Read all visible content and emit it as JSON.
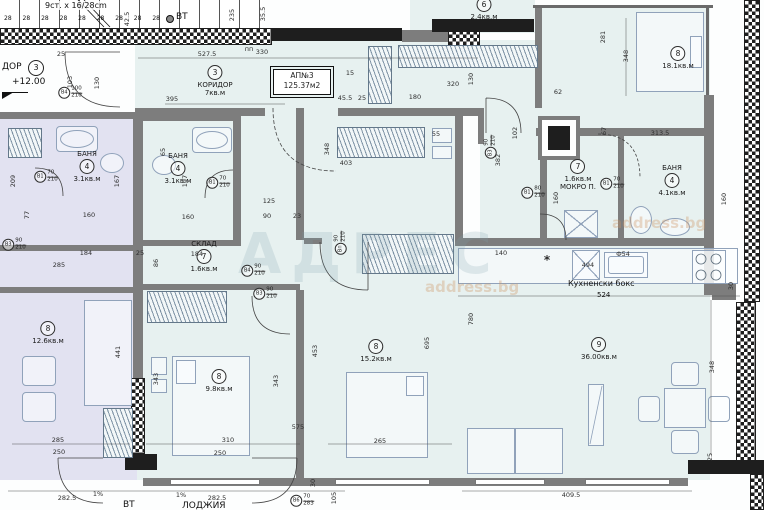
{
  "plan": {
    "apartment_box": {
      "line1": "АП№3",
      "line2": "125.37м2"
    },
    "stairs": {
      "note": "9ст. x 16/28cm",
      "treads": "28 28 28 28 28 28 28 28 28"
    },
    "landing": {
      "label": "ДОР",
      "num": "3",
      "level": "+12.00"
    },
    "vt_top": "ВТ",
    "vt_bottom": "ВТ",
    "kitchen": {
      "label": "Кухненски бокс",
      "dim": "524"
    },
    "loggia_label": "ЛОДЖИЯ",
    "watermark": {
      "main": "АДРЕС",
      "sub1": "address.bg",
      "sub2": "address.bg"
    },
    "rooms": [
      {
        "num": "3",
        "name": "КОРИДОР",
        "area": "7кв.м",
        "x": 215,
        "y": 64,
        "mode": "mid"
      },
      {
        "num": "6",
        "area": "2.4кв.м",
        "x": 484,
        "y": -4,
        "mode": "plain"
      },
      {
        "num": "8",
        "area": "18.1кв.м",
        "x": 678,
        "y": 45,
        "mode": "plain"
      },
      {
        "num": "4",
        "name": "БАНЯ",
        "area": "3.1кв.м",
        "x": 87,
        "y": 150,
        "mode": "above"
      },
      {
        "num": "4",
        "name": "БАНЯ",
        "area": "3.1кв.м",
        "x": 178,
        "y": 152,
        "mode": "above"
      },
      {
        "num": "7",
        "name": "СКЛАД",
        "area": "1.6кв.м",
        "x": 204,
        "y": 240,
        "mode": "above"
      },
      {
        "num": "7",
        "name": "МОКРО П.",
        "area": "1.6кв.м",
        "x": 578,
        "y": 158,
        "mode": "below"
      },
      {
        "num": "4",
        "name": "БАНЯ",
        "area": "4.1кв.м",
        "x": 672,
        "y": 164,
        "mode": "above"
      },
      {
        "num": "8",
        "area": "12.6кв.м",
        "x": 48,
        "y": 320,
        "mode": "plain"
      },
      {
        "num": "8",
        "area": "9.8кв.м",
        "x": 219,
        "y": 368,
        "mode": "plain"
      },
      {
        "num": "8",
        "area": "15.2кв.м",
        "x": 376,
        "y": 338,
        "mode": "plain"
      },
      {
        "num": "9",
        "area": "36.00кв.м",
        "x": 599,
        "y": 336,
        "mode": "plain"
      }
    ],
    "dims": [
      {
        "t": "527.5",
        "x": 207,
        "y": 54
      },
      {
        "t": "330",
        "x": 262,
        "y": 52
      },
      {
        "t": "25",
        "x": 61,
        "y": 54
      },
      {
        "t": "42.5",
        "x": 127,
        "y": 19,
        "r": 90
      },
      {
        "t": "235",
        "x": 232,
        "y": 15,
        "r": 90
      },
      {
        "t": "35.5",
        "x": 263,
        "y": 14,
        "r": 90
      },
      {
        "t": "пп",
        "x": 249,
        "y": 49
      },
      {
        "t": "395",
        "x": 172,
        "y": 99
      },
      {
        "t": "103",
        "x": 70,
        "y": 82,
        "r": 90
      },
      {
        "t": "130",
        "x": 97,
        "y": 83,
        "r": 90
      },
      {
        "t": "15",
        "x": 350,
        "y": 73
      },
      {
        "t": "45.5",
        "x": 345,
        "y": 98
      },
      {
        "t": "25",
        "x": 362,
        "y": 98
      },
      {
        "t": "320",
        "x": 453,
        "y": 84
      },
      {
        "t": "130",
        "x": 471,
        "y": 79,
        "r": 90
      },
      {
        "t": "180",
        "x": 415,
        "y": 97
      },
      {
        "t": "62",
        "x": 558,
        "y": 92
      },
      {
        "t": "281",
        "x": 603,
        "y": 37,
        "r": 90
      },
      {
        "t": "348",
        "x": 626,
        "y": 56,
        "r": 90
      },
      {
        "t": "313.5",
        "x": 660,
        "y": 133
      },
      {
        "t": "67",
        "x": 604,
        "y": 131,
        "r": 90
      },
      {
        "t": "102",
        "x": 515,
        "y": 133,
        "r": 90
      },
      {
        "t": "348",
        "x": 327,
        "y": 149,
        "r": 90
      },
      {
        "t": "403",
        "x": 346,
        "y": 163
      },
      {
        "t": "55",
        "x": 436,
        "y": 134
      },
      {
        "t": "125",
        "x": 269,
        "y": 201
      },
      {
        "t": "90",
        "x": 267,
        "y": 216
      },
      {
        "t": "23",
        "x": 297,
        "y": 216
      },
      {
        "t": "160",
        "x": 89,
        "y": 215
      },
      {
        "t": "160",
        "x": 188,
        "y": 217
      },
      {
        "t": "209",
        "x": 13,
        "y": 181,
        "r": 90
      },
      {
        "t": "197",
        "x": 185,
        "y": 181,
        "r": 90
      },
      {
        "t": "167",
        "x": 117,
        "y": 181,
        "r": 90
      },
      {
        "t": "77",
        "x": 27,
        "y": 215,
        "r": 90
      },
      {
        "t": "65",
        "x": 163,
        "y": 152,
        "r": 90
      },
      {
        "t": "184",
        "x": 86,
        "y": 253
      },
      {
        "t": "285",
        "x": 59,
        "y": 265
      },
      {
        "t": "86",
        "x": 156,
        "y": 263,
        "r": 90
      },
      {
        "t": "184",
        "x": 197,
        "y": 254
      },
      {
        "t": "25",
        "x": 140,
        "y": 253
      },
      {
        "t": "140",
        "x": 501,
        "y": 253
      },
      {
        "t": "382",
        "x": 498,
        "y": 160,
        "r": 90
      },
      {
        "t": "Ф54",
        "x": 623,
        "y": 254
      },
      {
        "t": "*",
        "x": 547,
        "y": 260,
        "big": 1
      },
      {
        "t": "494",
        "x": 588,
        "y": 265
      },
      {
        "t": "30",
        "x": 731,
        "y": 286,
        "r": 90
      },
      {
        "t": "160",
        "x": 556,
        "y": 198,
        "r": 90
      },
      {
        "t": "160",
        "x": 724,
        "y": 199,
        "r": 90
      },
      {
        "t": "780",
        "x": 471,
        "y": 319,
        "r": 90
      },
      {
        "t": "695",
        "x": 427,
        "y": 343,
        "r": 90
      },
      {
        "t": "453",
        "x": 315,
        "y": 351,
        "r": 90
      },
      {
        "t": "441",
        "x": 118,
        "y": 352,
        "r": 90
      },
      {
        "t": "343",
        "x": 156,
        "y": 379,
        "r": 90
      },
      {
        "t": "343",
        "x": 276,
        "y": 381,
        "r": 90
      },
      {
        "t": "348",
        "x": 712,
        "y": 367,
        "r": 90
      },
      {
        "t": "310",
        "x": 228,
        "y": 440
      },
      {
        "t": "250",
        "x": 220,
        "y": 453
      },
      {
        "t": "285",
        "x": 58,
        "y": 440
      },
      {
        "t": "250",
        "x": 59,
        "y": 452
      },
      {
        "t": "575",
        "x": 298,
        "y": 427
      },
      {
        "t": "265",
        "x": 380,
        "y": 441
      },
      {
        "t": "409.5",
        "x": 571,
        "y": 495
      },
      {
        "t": "282.5",
        "x": 67,
        "y": 498
      },
      {
        "t": "1%",
        "x": 98,
        "y": 494
      },
      {
        "t": "1%",
        "x": 181,
        "y": 495
      },
      {
        "t": "282.5",
        "x": 217,
        "y": 498
      },
      {
        "t": "105",
        "x": 334,
        "y": 498,
        "r": 90
      },
      {
        "t": "30",
        "x": 313,
        "y": 483,
        "r": 90
      },
      {
        "t": "25",
        "x": 710,
        "y": 457,
        "r": 90
      }
    ],
    "markers": [
      {
        "l": "В4",
        "a": "100",
        "b": "210",
        "x": 70,
        "y": 93
      },
      {
        "l": "В1",
        "a": "70",
        "b": "210",
        "x": 46,
        "y": 177
      },
      {
        "l": "В1",
        "a": "70",
        "b": "210",
        "x": 218,
        "y": 183
      },
      {
        "l": "В3",
        "a": "90",
        "b": "210",
        "x": 14,
        "y": 245
      },
      {
        "l": "В3",
        "a": "90",
        "b": "210",
        "x": 491,
        "y": 147,
        "r": 90
      },
      {
        "l": "Вп",
        "a": "90",
        "b": "210",
        "x": 341,
        "y": 243,
        "r": 90
      },
      {
        "l": "В4",
        "a": "90",
        "b": "210",
        "x": 253,
        "y": 271
      },
      {
        "l": "В1",
        "a": "80",
        "b": "210",
        "x": 533,
        "y": 193
      },
      {
        "l": "В1",
        "a": "70",
        "b": "210",
        "x": 612,
        "y": 184
      },
      {
        "l": "В6",
        "a": "70",
        "b": "283",
        "x": 302,
        "y": 501
      },
      {
        "l": "В3",
        "a": "90",
        "b": "210",
        "x": 265,
        "y": 294
      }
    ]
  }
}
